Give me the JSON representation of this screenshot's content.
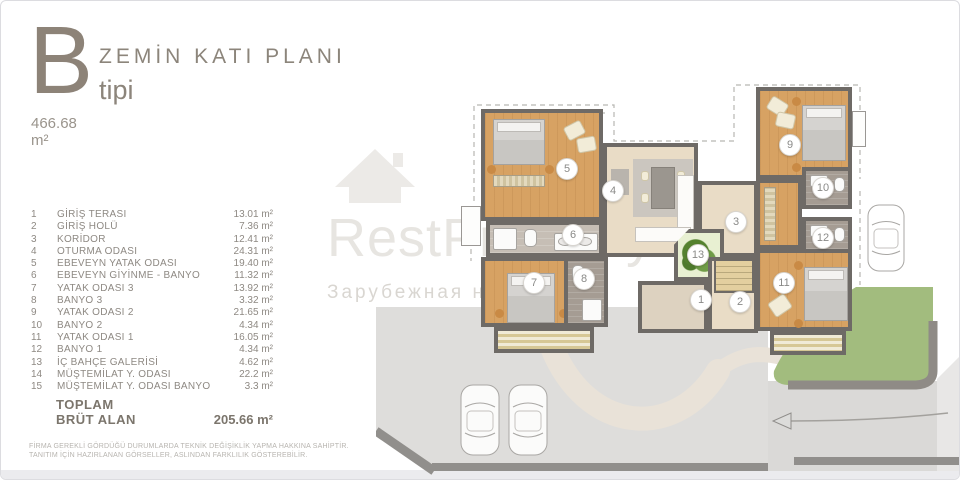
{
  "header": {
    "type_letter": "B",
    "type_label": "tipi",
    "plan_title": "ZEMİN KATI PLANI",
    "gross_area": "466.68 m²"
  },
  "legend": {
    "rows": [
      {
        "no": "1",
        "name": "GİRİŞ TERASI",
        "area": "13.01 m²"
      },
      {
        "no": "2",
        "name": "GİRİŞ HOLÜ",
        "area": "7.36 m²"
      },
      {
        "no": "3",
        "name": "KORİDOR",
        "area": "12.41 m²"
      },
      {
        "no": "4",
        "name": "OTURMA ODASI",
        "area": "24.31 m²"
      },
      {
        "no": "5",
        "name": "EBEVEYN YATAK ODASI",
        "area": "19.40 m²"
      },
      {
        "no": "6",
        "name": "EBEVEYN GİYİNME - BANYO",
        "area": "11.32 m²"
      },
      {
        "no": "7",
        "name": "YATAK ODASI 3",
        "area": "13.92 m²"
      },
      {
        "no": "8",
        "name": "BANYO 3",
        "area": "3.32 m²"
      },
      {
        "no": "9",
        "name": "YATAK ODASI 2",
        "area": "21.65 m²"
      },
      {
        "no": "10",
        "name": "BANYO 2",
        "area": "4.34 m²"
      },
      {
        "no": "11",
        "name": "YATAK ODASI 1",
        "area": "16.05 m²"
      },
      {
        "no": "12",
        "name": "BANYO 1",
        "area": "4.34 m²"
      },
      {
        "no": "13",
        "name": "İÇ BAHÇE GALERİSİ",
        "area": "4.62 m²"
      },
      {
        "no": "14",
        "name": "MÜŞTEMİLAT Y. ODASI",
        "area": "22.2 m²"
      },
      {
        "no": "15",
        "name": "MÜŞTEMİLAT Y. ODASI BANYO",
        "area": "3.3 m²"
      }
    ],
    "total_label_line1": "TOPLAM",
    "total_label_line2": "BRÜT ALAN",
    "total_value": "205.66 m²"
  },
  "disclaimer": {
    "line1": "FİRMA GEREKLİ GÖRDÜĞÜ DURUMLARDA TEKNİK DEĞİŞİKLİK YAPMA HAKKINA SAHİPTİR.",
    "line2": "TANITIM İÇİN HAZIRLANAN GÖRSELLER, ASLINDAN FARKLILIK GÖSTEREBİLİR."
  },
  "watermark": {
    "brand": "RestProperty",
    "subtitle": "Зарубежная недви"
  },
  "plan": {
    "markers": [
      {
        "label": "1"
      },
      {
        "label": "2"
      },
      {
        "label": "3"
      },
      {
        "label": "4"
      },
      {
        "label": "5"
      },
      {
        "label": "6"
      },
      {
        "label": "7"
      },
      {
        "label": "8"
      },
      {
        "label": "9"
      },
      {
        "label": "10"
      },
      {
        "label": "11"
      },
      {
        "label": "12"
      },
      {
        "label": "13"
      }
    ]
  }
}
